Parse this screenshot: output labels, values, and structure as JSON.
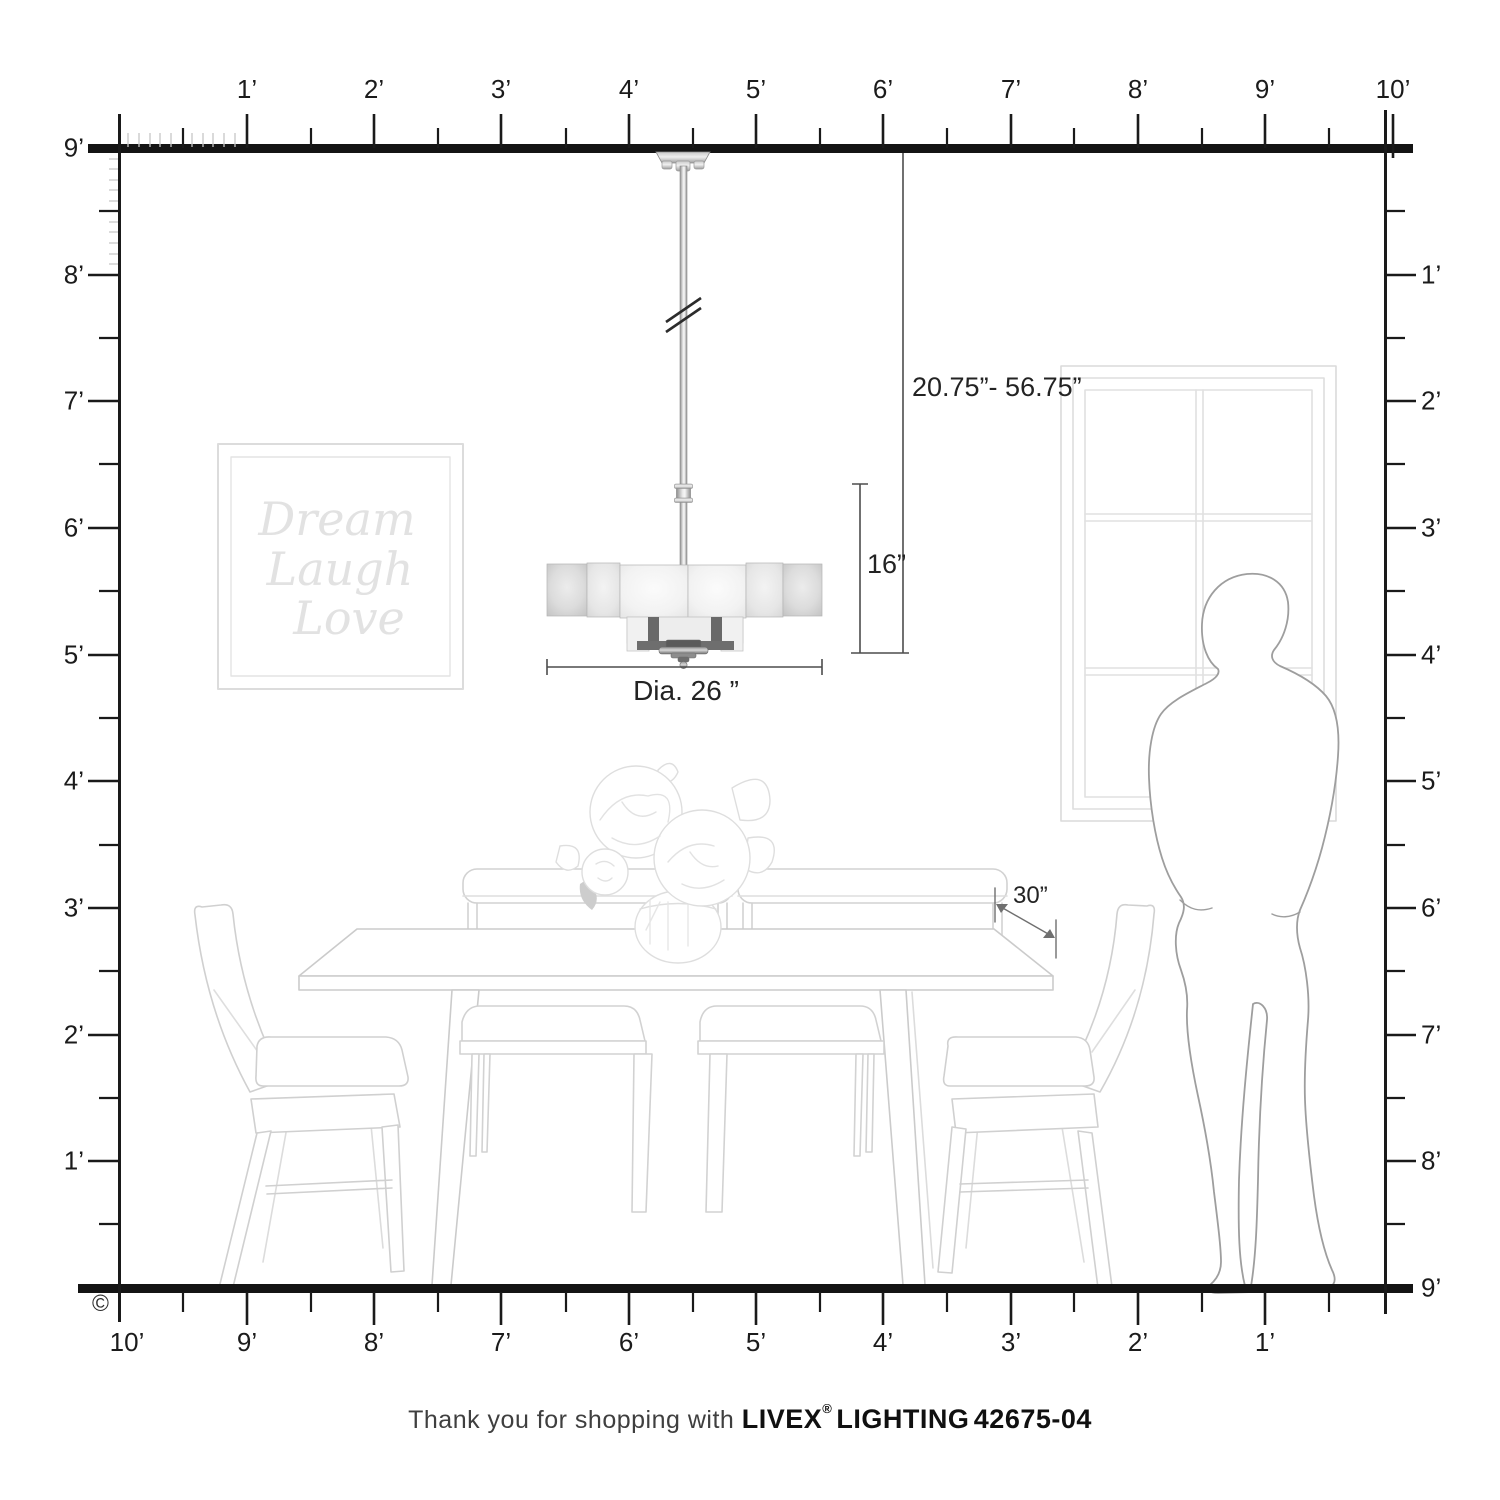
{
  "rulers": {
    "top": {
      "labels": [
        "1’",
        "2’",
        "3’",
        "4’",
        "5’",
        "6’",
        "7’",
        "8’",
        "9’",
        "10’"
      ]
    },
    "left": {
      "labels": [
        "9’",
        "8’",
        "7’",
        "6’",
        "5’",
        "4’",
        "3’",
        "2’",
        "1’"
      ]
    },
    "right": {
      "labels": [
        "1’",
        "2’",
        "3’",
        "4’",
        "5’",
        "6’",
        "7’",
        "8’",
        "9’"
      ]
    },
    "bottom": {
      "labels": [
        "10’",
        "9’",
        "8’",
        "7’",
        "6’",
        "5’",
        "4’",
        "3’",
        "2’",
        "1’"
      ]
    }
  },
  "dimensions": {
    "hang_range": "20.75”- 56.75”",
    "fixture_height": "16”",
    "diameter": "Dia. 26 ”",
    "clearance": "30”"
  },
  "wall_art": {
    "line1": "Dream",
    "line2": "Laugh",
    "line3": "Love"
  },
  "footer": {
    "prefix": "Thank you for shopping with ",
    "brand": "LIVEX",
    "registered": "®",
    "lighting": "LIGHTING",
    "sku": "42675-04"
  },
  "copyright": "©",
  "colors": {
    "ruler": "#1a1a1a",
    "dimension_line": "#4d4d4d",
    "scene_line": "#d2d2d2",
    "person_line": "#9e9e9e",
    "shade_glass": "#ececec"
  }
}
